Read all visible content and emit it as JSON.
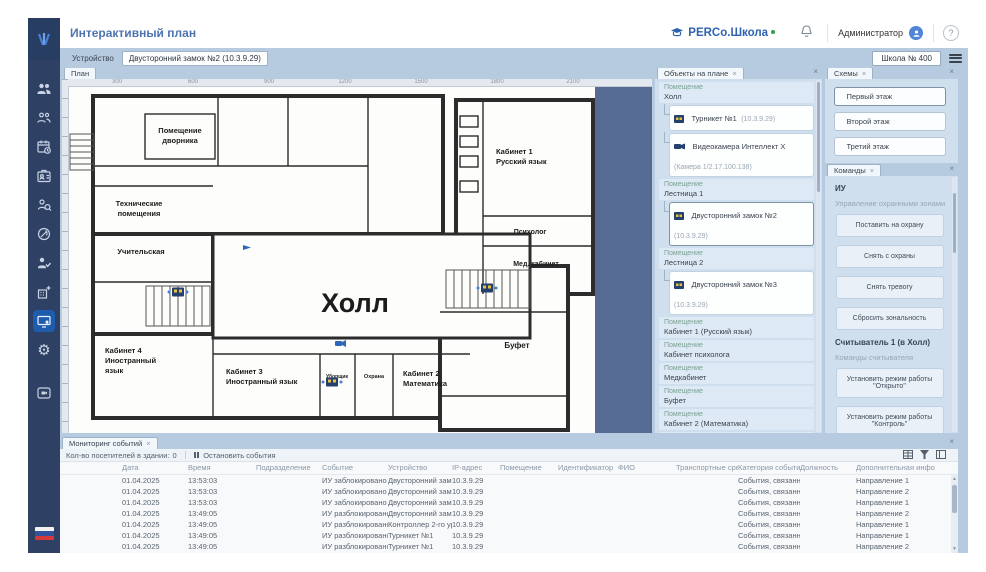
{
  "ui": {
    "close": "×",
    "arrow_up": "▲",
    "arrow_down": "▼"
  },
  "header": {
    "title": "Интерактивный план",
    "brand": "PERCo.Школа",
    "user": "Администратор",
    "help": "?"
  },
  "toolbar": {
    "device_label": "Устройство",
    "device_value": "Двусторонний замок №2 (10.3.9.29)",
    "school": "Школа № 400"
  },
  "sidebar": {
    "icons": [
      "employees-icon",
      "visitors-icon",
      "calendar-clock-icon",
      "id-badge-icon",
      "person-search-icon",
      "circle-slash-icon",
      "person-check-icon",
      "building-plus-icon",
      "monitor-user-icon",
      "gear-icon",
      "video-frame-icon"
    ]
  },
  "plan": {
    "tab": "План",
    "ruler": [
      "300",
      "600",
      "900",
      "1200",
      "1500",
      "1800",
      "2100"
    ],
    "rooms": {
      "janitor1": "Помещение",
      "janitor2": "дворника",
      "tech1": "Технические",
      "tech2": "помещения",
      "teachers": "Учительская",
      "hall": "Холл",
      "cab4_1": "Кабинет 4",
      "cab4_2": "Иностранный",
      "cab4_3": "язык",
      "cab3_1": "Кабинет 3",
      "cab3_2": "Иностранный язык",
      "cleaner": "Уборщик",
      "guard": "Охрана",
      "cab2_1": "Кабинет 2",
      "cab2_2": "Математика",
      "buffet": "Буфет",
      "cab1_1": "Кабинет 1",
      "cab1_2": "Русский язык",
      "psych": "Психолог",
      "med": "Мед. кабинет"
    }
  },
  "objects_panel": {
    "tab": "Объекты на плане",
    "list": [
      {
        "type": "group",
        "label": "Помещение",
        "name": "Холл"
      },
      {
        "type": "device",
        "icon": "turnstile",
        "name": "Турникет №1",
        "sub": "(10.3.9.29)"
      },
      {
        "type": "device",
        "icon": "camera",
        "name": "Видеокамера Интеллект Х",
        "sub": "(Камера 1/2.17.100.138)"
      },
      {
        "type": "group",
        "label": "Помещение",
        "name": "Лестница 1"
      },
      {
        "type": "device",
        "icon": "turnstile",
        "name": "Двусторонний замок №2",
        "sub": "(10.3.9.29)"
      },
      {
        "type": "group",
        "label": "Помещение",
        "name": "Лестница 2"
      },
      {
        "type": "device",
        "icon": "turnstile",
        "name": "Двусторонний замок №3",
        "sub": "(10.3.9.29)"
      },
      {
        "type": "group",
        "label": "Помещение",
        "name": "Кабинет 1 (Русский язык)"
      },
      {
        "type": "group",
        "label": "Помещение",
        "name": "Кабинет психолога"
      },
      {
        "type": "group",
        "label": "Помещение",
        "name": "Медкабинет"
      },
      {
        "type": "group",
        "label": "Помещение",
        "name": "Буфет"
      },
      {
        "type": "group",
        "label": "Помещение",
        "name": "Кабинет 2 (Математика)"
      },
      {
        "type": "group",
        "label": "Помещение",
        "name": "Кабинет охраны"
      },
      {
        "type": "group",
        "label": "Помещение",
        "name": "Инвентарь для уборки"
      },
      {
        "type": "group",
        "label": "Помещение",
        "name": "Кабинет 3 (Ин. язык)"
      },
      {
        "type": "group",
        "label": "Помещение",
        "name": "Кабинет 4 (Ин. язык)"
      }
    ]
  },
  "schemes_panel": {
    "tab": "Схемы",
    "items": [
      "Первый этаж",
      "Второй этаж",
      "Третий этаж"
    ]
  },
  "commands_panel": {
    "tab": "Команды",
    "iu_heading": "ИУ",
    "zones_label": "Управление охранными зонами",
    "zone_buttons": [
      "Поставить на охрану",
      "Снять с охраны",
      "Снять тревогу",
      "Сбросить зональность"
    ],
    "reader_heading": "Считыватель 1 (в Холл)",
    "reader_label": "Команды считывателя",
    "reader_buttons": [
      "Установить режим работы \"Открыто\"",
      "Установить режим работы \"Контроль\""
    ]
  },
  "events_panel": {
    "tab": "Мониторинг событий",
    "visitors_label": "Кол-во посетителей в здании:",
    "visitors_count": "0",
    "stop_button": "Остановить события",
    "columns": [
      "Дата",
      "Время",
      "Подразделение",
      "Событие",
      "Устройство",
      "IP-адрес",
      "Помещение",
      "Идентификатор",
      "ФИО",
      "Транспортные средст",
      "Категория событий",
      "Должность",
      "Дополнительная инфо"
    ],
    "rows": [
      [
        "01.04.2025",
        "13:53:03",
        "",
        "ИУ заблокировано",
        "Двусторонний замок №2",
        "10.3.9.29",
        "",
        "",
        "",
        "",
        "События, связанные с",
        "",
        "Направление 1"
      ],
      [
        "01.04.2025",
        "13:53:03",
        "",
        "ИУ заблокировано",
        "Двусторонний замок №2",
        "10.3.9.29",
        "",
        "",
        "",
        "",
        "События, связанные с",
        "",
        "Направление 2"
      ],
      [
        "01.04.2025",
        "13:53:03",
        "",
        "ИУ заблокировано",
        "Двусторонний замок №2",
        "10.3.9.29",
        "",
        "",
        "",
        "",
        "События, связанные с",
        "",
        "Направление 1"
      ],
      [
        "01.04.2025",
        "13:49:05",
        "",
        "ИУ разблокировано",
        "Двусторонний замок №2",
        "10.3.9.29",
        "",
        "",
        "",
        "",
        "События, связанные с",
        "",
        "Направление 2"
      ],
      [
        "01.04.2025",
        "13:49:05",
        "",
        "ИУ разблокировано",
        "Контроллер 2-го уров",
        "10.3.9.29",
        "",
        "",
        "",
        "",
        "События, связанные с",
        "",
        "Направление 1"
      ],
      [
        "01.04.2025",
        "13:49:05",
        "",
        "ИУ разблокировано",
        "Турникет №1",
        "10.3.9.29",
        "",
        "",
        "",
        "",
        "События, связанные с",
        "",
        "Направление 1"
      ],
      [
        "01.04.2025",
        "13:49:05",
        "",
        "ИУ разблокировано",
        "Турникет №1",
        "10.3.9.29",
        "",
        "",
        "",
        "",
        "События, связанные с",
        "",
        "Направление 2"
      ]
    ]
  }
}
